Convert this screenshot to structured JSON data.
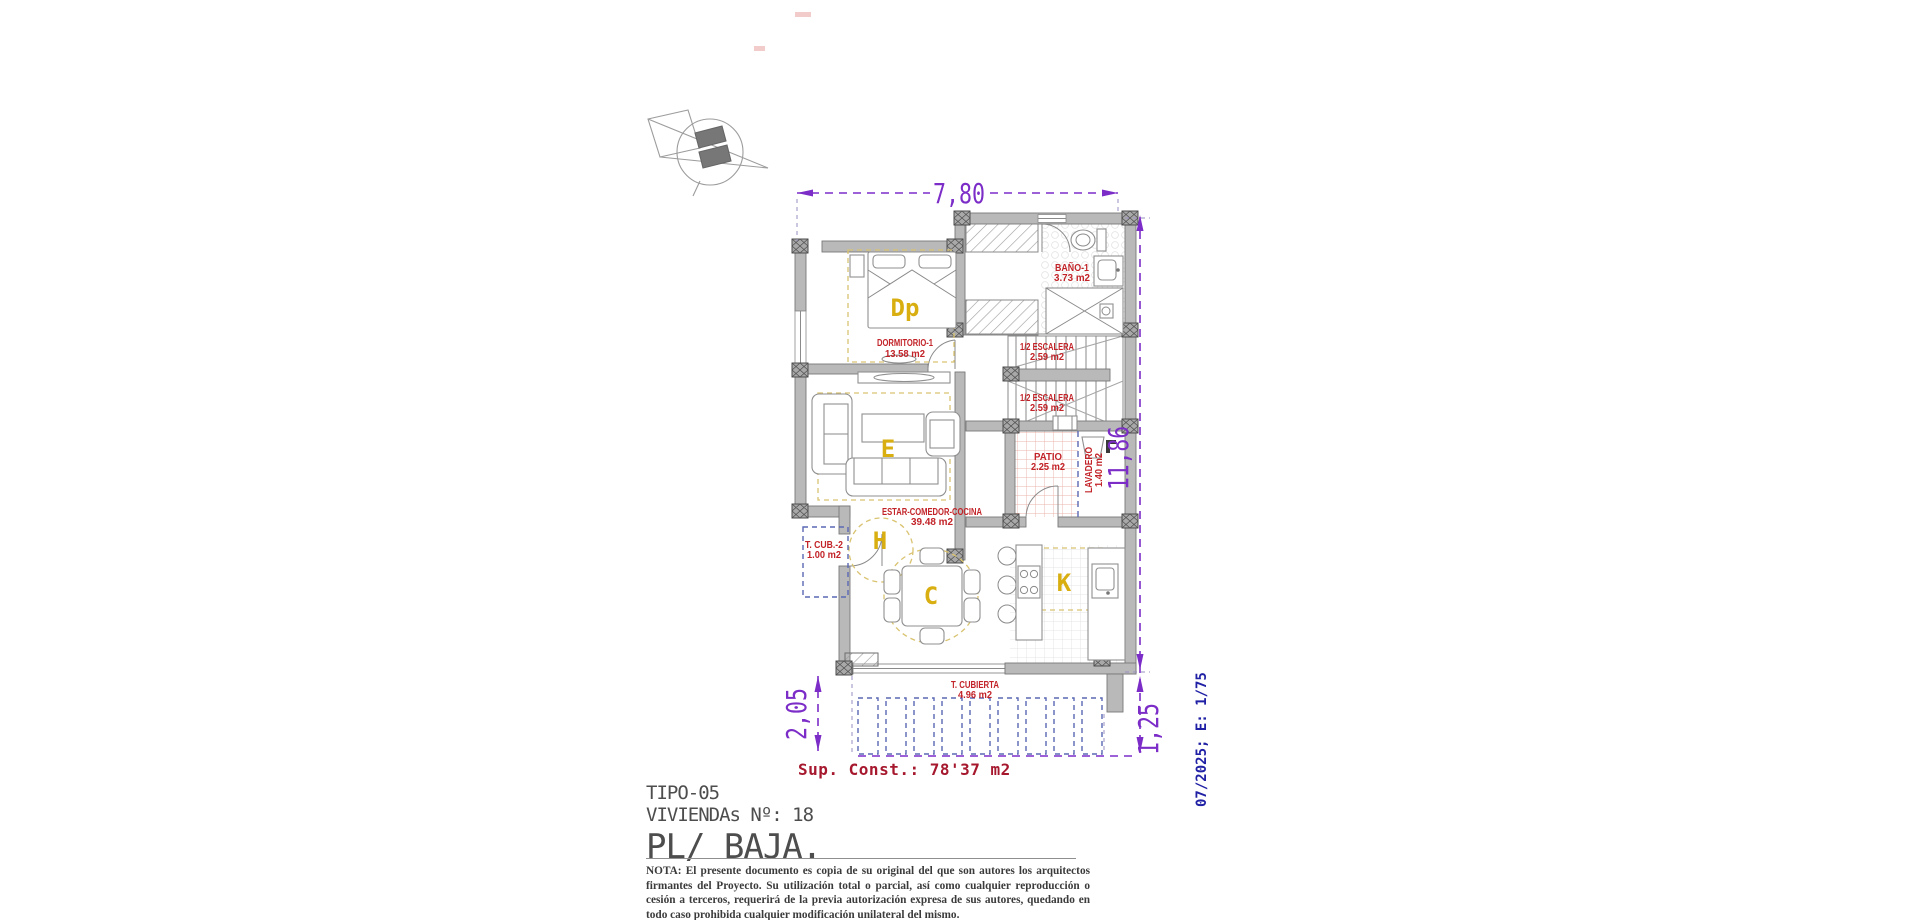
{
  "drawing": {
    "type": "floor-plan",
    "colors": {
      "dimension": "#7c2dc8",
      "room_label": "#c22328",
      "zone_letter": "#d8ae10",
      "wall": "#b9b9b9",
      "title_text": "#4d4d4d",
      "sup_const_text": "#a6182e",
      "stamp_text": "#2121a6",
      "pergola_dash": "#5a68b4"
    }
  },
  "dimensions": {
    "top_width": "7,80",
    "right_height": "11,86",
    "terrace_left": "2,05",
    "terrace_right": "1,25"
  },
  "rooms": {
    "dormitorio": {
      "name": "DORMITORIO-1",
      "area": "13.58 m2"
    },
    "bano": {
      "name": "BAÑO-1",
      "area": "3.73 m2"
    },
    "escalera_a": {
      "name": "1/2 ESCALERA",
      "area": "2.59 m2"
    },
    "escalera_b": {
      "name": "1/2 ESCALERA",
      "area": "2.59 m2"
    },
    "patio": {
      "name": "PATIO",
      "area": "2.25 m2"
    },
    "lavadero": {
      "name": "LAVADERO",
      "area": "1.40 m2"
    },
    "estar": {
      "name": "ESTAR-COMEDOR-COCINA",
      "area": "39.48 m2"
    },
    "t_cub_2": {
      "name": "T. CUB.-2",
      "area": "1.00 m2"
    },
    "t_cubierta": {
      "name": "T. CUBIERTA",
      "area": "4.96 m2"
    }
  },
  "zone_letters": {
    "dormitorio": "Dp",
    "estar": "E",
    "hall": "H",
    "comedor": "C",
    "cocina": "K"
  },
  "summary": {
    "sup_const": "Sup. Const.: 78'37 m2"
  },
  "title_block": {
    "tipo": "TIPO-05",
    "viviendas": "VIVIENDAs Nº: 18",
    "planta": "PL/ BAJA."
  },
  "note": "NOTA: El presente documento es copia de su original del que son autores los arquitectos firmantes del Proyecto. Su utilización total o parcial, así como cualquier reproducción o cesión a terceros, requerirá  de la previa autorización expresa de sus autores, quedando en todo caso prohibida cualquier modificación unilateral del mismo.",
  "stamp": "07/2025; E: 1/75"
}
